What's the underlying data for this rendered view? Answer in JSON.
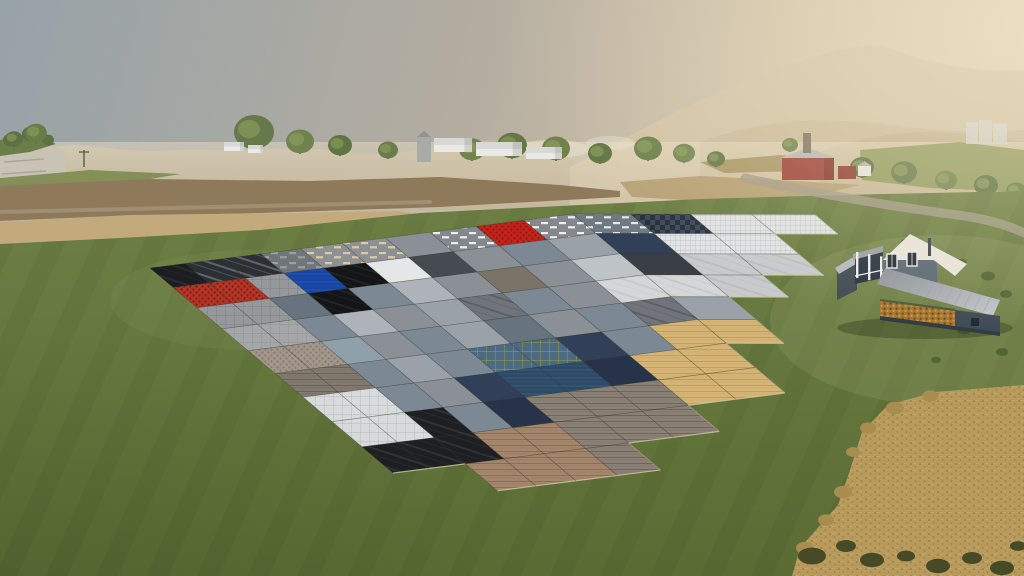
{
  "scene": {
    "label": "Farming Simulator landscape with ground texture sample grid, farmhouse and wheat field",
    "viewport": {
      "w": 1024,
      "h": 576
    }
  },
  "sky": {
    "top_left": "#97a2a8",
    "mid": "#b4ada0",
    "warm_right": "#d6c7ab",
    "horizon": "#e2d4b8"
  },
  "mountains": [
    {
      "name": "big-right-mountain",
      "d": "M560,172 C640,132 720,82 830,52 C860,44 880,44 900,52 C950,70 1000,72 1024,70 L1024,210 L560,210 Z",
      "fill": "#d2c3a5",
      "o": 0.9
    },
    {
      "name": "left-range",
      "d": "M0,158 C40,146 70,142 110,148 C150,154 180,148 220,150 C260,152 300,144 340,152 C380,158 420,150 470,142 C510,136 540,140 570,152 L570,210 L0,210 Z",
      "fill": "#c3b69a",
      "o": 0.85
    },
    {
      "name": "mid-ridge-right",
      "d": "M700,142 C760,120 820,116 880,124 C930,130 980,134 1024,130 L1024,210 L700,210 Z",
      "fill": "#c8b997",
      "o": 0.8
    },
    {
      "name": "near-hills-right",
      "d": "M820,152 C870,132 930,128 980,136 L1024,142 L1024,210 L820,210 Z",
      "fill": "#c0b08e",
      "o": 0.8
    }
  ],
  "smoke_puffs": [
    {
      "x": 552,
      "y": 149,
      "rx": 38,
      "ry": 9,
      "o": 0.45
    },
    {
      "x": 610,
      "y": 143,
      "rx": 24,
      "ry": 7,
      "o": 0.35
    }
  ],
  "haze": {
    "color": "232,221,197",
    "y": 142,
    "h": 66
  },
  "cliff": {
    "rock": "0,146 30,140 52,144 64,152 66,170 50,186 28,200 0,208",
    "rock_fill": "#c9c3b5",
    "strata": [
      [
        4,
        162,
        40
      ],
      [
        2,
        174,
        44
      ],
      [
        6,
        186,
        32
      ]
    ],
    "strata_color": "#a59e90",
    "top": "0,140 34,134 56,144 30,152 0,156",
    "top_fill": "#6b7e4a",
    "trees": [
      [
        10,
        140,
        7
      ],
      [
        30,
        134,
        8
      ],
      [
        48,
        140,
        6
      ]
    ]
  },
  "field_strips": [
    {
      "name": "green-slope-left",
      "pts": "0,178 90,170 180,174 120,184 40,188 0,192",
      "fill": "#7d8a50",
      "o": 0.9
    },
    {
      "name": "plowed-brown",
      "pts": "0,186 150,179 310,181 440,177 560,185 620,191 620,197 440,207 260,213 90,217 0,221",
      "fill": "#8e795b",
      "o": 1
    },
    {
      "name": "stubble-tan",
      "pts": "0,222 130,215 280,213 400,211 428,216 380,228 240,237 100,244 0,248",
      "fill": "#c2aa7d",
      "o": 1
    },
    {
      "name": "tan-right-1",
      "pts": "620,182 700,176 780,180 860,185 810,197 700,201 632,197",
      "fill": "#b59f72",
      "o": 0.95
    },
    {
      "name": "tan-right-2",
      "pts": "700,162 780,155 830,159 804,171 724,173",
      "fill": "#a5925f",
      "o": 0.9
    },
    {
      "name": "green-hill-right",
      "pts": "860,150 960,142 1024,150 1024,192 930,188 862,180",
      "fill": "#8e9a5c",
      "o": 0.95
    }
  ],
  "treeline": [
    {
      "x": 14,
      "y": 147,
      "r": 9,
      "c": "#5e7143"
    },
    {
      "x": 36,
      "y": 143,
      "r": 11,
      "c": "#687c4a"
    },
    {
      "x": 254,
      "y": 150,
      "r": 20,
      "c": "#66794a"
    },
    {
      "x": 300,
      "y": 154,
      "r": 14,
      "c": "#70834f"
    },
    {
      "x": 340,
      "y": 156,
      "r": 12,
      "c": "#5f7343"
    },
    {
      "x": 388,
      "y": 159,
      "r": 10,
      "c": "#6a7d4b"
    },
    {
      "x": 472,
      "y": 161,
      "r": 13,
      "c": "#71854f"
    },
    {
      "x": 512,
      "y": 159,
      "r": 15,
      "c": "#647846"
    },
    {
      "x": 556,
      "y": 161,
      "r": 14,
      "c": "#6d8049"
    },
    {
      "x": 600,
      "y": 164,
      "r": 12,
      "c": "#5f7342"
    },
    {
      "x": 648,
      "y": 161,
      "r": 14,
      "c": "#6a7e48"
    },
    {
      "x": 684,
      "y": 163,
      "r": 11,
      "c": "#73864f"
    },
    {
      "x": 716,
      "y": 167,
      "r": 9,
      "c": "#647847"
    },
    {
      "x": 790,
      "y": 152,
      "r": 8,
      "c": "#6f8249"
    },
    {
      "x": 862,
      "y": 178,
      "r": 12,
      "c": "#5c7040"
    },
    {
      "x": 904,
      "y": 184,
      "r": 13,
      "c": "#66794a"
    },
    {
      "x": 946,
      "y": 190,
      "r": 11,
      "c": "#70834e"
    },
    {
      "x": 986,
      "y": 196,
      "r": 12,
      "c": "#5e7242"
    },
    {
      "x": 1016,
      "y": 200,
      "r": 10,
      "c": "#697d48"
    }
  ],
  "buildings": {
    "sheds": [
      {
        "x": 434,
        "y": 152,
        "w": 38,
        "h": 14
      },
      {
        "x": 476,
        "y": 156,
        "w": 46,
        "h": 14
      },
      {
        "x": 526,
        "y": 159,
        "w": 36,
        "h": 12
      },
      {
        "x": 224,
        "y": 151,
        "w": 20,
        "h": 9
      },
      {
        "x": 248,
        "y": 153,
        "w": 15,
        "h": 8
      }
    ],
    "shed_roof": "#d8d9d6",
    "shed_wall": "#ebe9e5",
    "elevator": {
      "x": 417,
      "y": 137,
      "w": 14,
      "h": 25,
      "c": "#a8aba8"
    },
    "barn": {
      "x": 782,
      "y": 158,
      "w": 52,
      "h": 22,
      "wall": "#9e4136",
      "roof": "#b5b8b4"
    },
    "barn_annex": {
      "x": 838,
      "y": 166,
      "w": 18,
      "h": 13,
      "c": "#8e3d33"
    },
    "white_house": {
      "x": 858,
      "y": 166,
      "w": 13,
      "h": 10,
      "c": "#e8e5de"
    },
    "mine_tower": {
      "x": 803,
      "y": 133,
      "w": 8,
      "h": 20,
      "c": "#6e6557"
    },
    "far_silos": {
      "x": 966,
      "y": 118,
      "c": "#d3d6d4",
      "parts": [
        [
          0,
          4,
          12,
          22
        ],
        [
          13,
          2,
          13,
          24
        ],
        [
          27,
          5,
          14,
          21
        ]
      ]
    },
    "power_pole": {
      "x": 84,
      "y1": 150,
      "y2": 167,
      "c": "#565748"
    }
  },
  "hedges": [
    [
      640,
      205
    ],
    [
      664,
      206
    ],
    [
      688,
      206
    ],
    [
      712,
      207
    ],
    [
      736,
      207
    ],
    [
      760,
      208
    ],
    [
      790,
      208
    ],
    [
      816,
      208
    ],
    [
      842,
      209
    ],
    [
      868,
      210
    ],
    [
      894,
      210
    ],
    [
      920,
      211
    ]
  ],
  "hedge_color": "#4c5c33",
  "roads": [
    {
      "name": "road-right",
      "d": "M745,178 C800,190 880,205 965,216 C990,220 1010,226 1024,233",
      "w": 9,
      "c": "#a39b87",
      "o": 0.8
    },
    {
      "name": "track-left",
      "d": "M0,212 C120,208 260,206 430,202",
      "w": 4,
      "c": "#b3a68c",
      "o": 0.5
    }
  ],
  "grass": {
    "top_edge": "0,244 120,238 260,230 420,213 560,206 700,199 840,195 1024,191 1024,576 0,576",
    "light": "#6d8044",
    "dark": "#5a6c34",
    "stripe_opacity": 0.05
  },
  "texture_grid": {
    "palette": {
      "blk": {
        "b": "#1b1d20",
        "p": "streaks",
        "pc": "#33373b"
      },
      "blk2": {
        "b": "#141517",
        "p": "streaks",
        "pc": "#2c2f33"
      },
      "smk": {
        "b": "#2c2f34",
        "p": "streaks",
        "pc": "#8a9097"
      },
      "gsl": {
        "b": "#70757a",
        "p": "dashes",
        "pc": "#9aa0a6"
      },
      "bdsh": {
        "b": "#8d9196",
        "p": "dashes",
        "pc": "#dcc9a0"
      },
      "wdsh": {
        "b": "#84888d",
        "p": "dashes",
        "pc": "#eceef0"
      },
      "ddsh": {
        "b": "#6f7981",
        "p": "dashes",
        "pc": "#e2e7eb"
      },
      "red": {
        "b": "#c2241c",
        "p": "dots",
        "pc": "#8e1712"
      },
      "rbk": {
        "b": "#b23527",
        "p": "dots",
        "pc": "#7a1d12"
      },
      "gpv": {
        "b": "#96989b",
        "p": "grid",
        "pc": "#7c7f83"
      },
      "blu": {
        "b": "#1745a2",
        "p": "waves",
        "pc": "#2f62c8"
      },
      "bwt": {
        "b": "#2c4a66",
        "p": "waves",
        "pc": "#49688a"
      },
      "bgr": {
        "b": "#4c6a82",
        "p": "grid",
        "pc": "#99a33e"
      },
      "wht": {
        "b": "#e5e6e7",
        "p": null,
        "pc": null
      },
      "gdk": {
        "b": "#464b51",
        "p": null,
        "pc": null
      },
      "gdk2": {
        "b": "#3a3f45",
        "p": null,
        "pc": null
      },
      "gmd": {
        "b": "#8b9097",
        "p": null,
        "pc": null
      },
      "gmd2": {
        "b": "#9ba1a8",
        "p": null,
        "pc": null
      },
      "glt": {
        "b": "#adb3b9",
        "p": null,
        "pc": null
      },
      "glt2": {
        "b": "#bec3c8",
        "p": null,
        "pc": null
      },
      "gbl": {
        "b": "#7c8893",
        "p": null,
        "pc": null
      },
      "gbl2": {
        "b": "#67737e",
        "p": null,
        "pc": null
      },
      "gbl3": {
        "b": "#90a0ab",
        "p": null,
        "pc": null
      },
      "gbr": {
        "b": "#7b7368",
        "p": null,
        "pc": null
      },
      "nchk": {
        "b": "#242d3a",
        "p": "checker",
        "pc": "#3b4859"
      },
      "wrib": {
        "b": "#e1e3e5",
        "p": "rib",
        "pc": "#b2b8bd"
      },
      "ndk": {
        "b": "#323f58",
        "p": null,
        "pc": null
      },
      "ndk2": {
        "b": "#263349",
        "p": null,
        "pc": null
      },
      "lcon": {
        "b": "#c8cacc",
        "p": "streaks",
        "pc": "#b0b3b6"
      },
      "mrb": {
        "b": "#d4d6d7",
        "p": "streaks",
        "pc": "#bcc0c3"
      },
      "smst": {
        "b": "#70757b",
        "p": "streaks",
        "pc": "#4b4f55"
      },
      "gcn": {
        "b": "#a4a6a8",
        "p": "grid",
        "pc": "#909295"
      },
      "cbt": {
        "b": "#a3968a",
        "p": "dots",
        "pc": "#867a6d"
      },
      "dcn": {
        "b": "#837b70",
        "p": "hlines",
        "pc": "#6a6359"
      },
      "wtg": {
        "b": "#d8dadc",
        "p": "grid",
        "pc": "#b5b9bd"
      },
      "soi": {
        "b": "#1e1f22",
        "p": "streaks",
        "pc": "#3b3f43"
      },
      "pwd": {
        "b": "#a5876d",
        "p": "hlines",
        "pc": "#8a6f57"
      },
      "wwd": {
        "b": "#8b8277",
        "p": "hlines",
        "pc": "#6d665c"
      },
      "pin": {
        "b": "#d6b678",
        "p": "hlines",
        "pc": "#c09e5e"
      }
    },
    "rows": [
      [
        "blk",
        "smk",
        "smk",
        "gsl",
        "bdsh",
        "bdsh",
        "gmd",
        "wdsh",
        "red",
        "wdsh",
        "ddsh",
        "nchk",
        "wrib",
        "wrib"
      ],
      [
        "rbk",
        "rbk",
        "gpv",
        "blu",
        "blk2",
        "wht",
        "gdk",
        "gmd",
        "gbl",
        "gmd2",
        "ndk",
        "wrib",
        "wrib",
        null
      ],
      [
        "gpv",
        "gpv",
        "gbl2",
        "blk2",
        "gbl",
        "glt",
        "gmd",
        "gbr",
        "gmd",
        "glt2",
        "gdk2",
        "lcon",
        "lcon",
        null
      ],
      [
        "gcn",
        "gcn",
        "gbl",
        "glt",
        "gmd",
        "gmd2",
        "smst",
        "gbl",
        "gmd",
        "mrb",
        "mrb",
        "lcon",
        null,
        null
      ],
      [
        "cbt",
        "cbt",
        "gbl3",
        "gmd",
        "gbl",
        "gmd2",
        "gbl2",
        "gmd",
        "gbl",
        "smst",
        "gmd2",
        null,
        null,
        null
      ],
      [
        "dcn",
        "dcn",
        "gbl",
        "gmd2",
        "gbl",
        "bgr",
        "bgr",
        "ndk",
        "gbl",
        "pin",
        "pin",
        null,
        null,
        null
      ],
      [
        "wtg",
        "wtg",
        "gbl",
        "gmd",
        "ndk",
        "bwt",
        "bwt",
        "ndk2",
        "pin",
        "pin",
        null,
        null,
        null,
        null
      ],
      [
        "wtg",
        "wtg",
        "soi",
        "gbl",
        "ndk2",
        "wwd",
        "wwd",
        "wwd",
        "pin",
        "pin",
        null,
        null,
        null,
        null
      ],
      [
        "soi",
        "soi",
        "soi",
        "pwd",
        "pwd",
        "wwd",
        "wwd",
        "wwd",
        null,
        null,
        null,
        null,
        null,
        null
      ],
      [
        null,
        null,
        "pwd",
        "pwd",
        "pwd",
        "wwd",
        null,
        null,
        null,
        null,
        null,
        null,
        null,
        null
      ]
    ],
    "seam_color": "rgba(45,52,44,0.35)",
    "edge_highlight": "#d6cda6"
  },
  "farmhouse": {
    "wall": "#54626e",
    "wall_dark": "#3f4b55",
    "gable_wall": "#5a6874",
    "white_roof": "#e9e5da",
    "metal_roof_light": "#c4c8cb",
    "metal_roof_dark": "#8a9098",
    "rib": "#9aa0a6",
    "porch_roof": "#9aa0a5",
    "opening": "#273440",
    "trim": "#eceeef",
    "window": "#1f2a34",
    "wood": "#a5762f",
    "wood_dark": "#6f4a1e",
    "beam_green": "#4a5c3a",
    "foundation": "#333c43",
    "shadow": "rgba(45,55,30,0.38)"
  },
  "wheat": {
    "pts": "1024,385 935,392 888,405 862,432 850,470 838,505 800,548 792,576 1024,576",
    "fill": "#b79a5c",
    "speckle": "#8d7644",
    "light": "#c9ad6e",
    "edge_clumps": [
      [
        930,
        396,
        8
      ],
      [
        895,
        408,
        9
      ],
      [
        868,
        428,
        8
      ],
      [
        853,
        452,
        7
      ],
      [
        843,
        492,
        9
      ],
      [
        826,
        520,
        8
      ],
      [
        805,
        548,
        9
      ]
    ],
    "edge_clump_color": "#a88c50",
    "bushes": [
      [
        812,
        556,
        14
      ],
      [
        846,
        546,
        10
      ],
      [
        872,
        560,
        12
      ],
      [
        906,
        556,
        9
      ],
      [
        938,
        566,
        12
      ],
      [
        972,
        558,
        10
      ],
      [
        1002,
        568,
        12
      ],
      [
        1018,
        546,
        8
      ]
    ],
    "bush_color": "#474a26"
  },
  "scatter_bushes": [
    [
      906,
      242,
      5
    ],
    [
      934,
      252,
      6
    ],
    [
      962,
      262,
      5
    ],
    [
      988,
      276,
      7
    ],
    [
      1006,
      294,
      6
    ],
    [
      948,
      300,
      5
    ],
    [
      918,
      318,
      6
    ],
    [
      964,
      330,
      7
    ],
    [
      1002,
      352,
      6
    ],
    [
      936,
      360,
      5
    ],
    [
      898,
      282,
      4
    ]
  ],
  "scatter_bush_color": "#4f6234"
}
